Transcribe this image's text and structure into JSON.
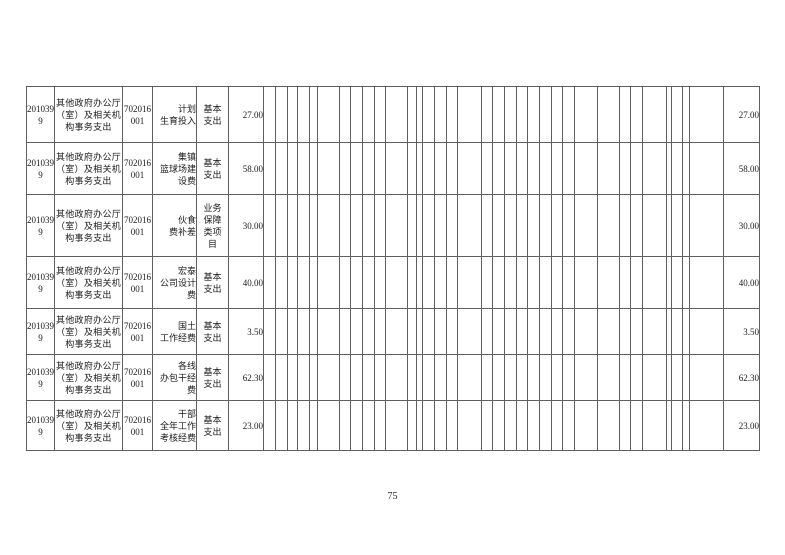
{
  "page": {
    "number": "75"
  },
  "colors": {
    "border": "#5f5f5f",
    "text": "#1b1b1b",
    "background": "#ffffff"
  },
  "table": {
    "rows": [
      {
        "func_code": "201039\n9",
        "func_name": "其他政府办公厅\n（室）及相关机\n构事务支出",
        "econ_code": "702016\n001",
        "project": "计划\n生育投入",
        "expense_type": "基本\n支出",
        "amount": "27.00",
        "amount_total": "27.00"
      },
      {
        "func_code": "201039\n9",
        "func_name": "其他政府办公厅\n（室）及相关机\n构事务支出",
        "econ_code": "702016\n001",
        "project": "集镇\n篮球场建\n设费",
        "expense_type": "基本\n支出",
        "amount": "58.00",
        "amount_total": "58.00"
      },
      {
        "func_code": "201039\n9",
        "func_name": "其他政府办公厅\n（室）及相关机\n构事务支出",
        "econ_code": "702016\n001",
        "project": "伙食\n费补差",
        "expense_type": "业务\n保障\n类项\n目",
        "amount": "30.00",
        "amount_total": "30.00"
      },
      {
        "func_code": "201039\n9",
        "func_name": "其他政府办公厅\n（室）及相关机\n构事务支出",
        "econ_code": "702016\n001",
        "project": "宏泰\n公司设计\n费",
        "expense_type": "基本\n支出",
        "amount": "40.00",
        "amount_total": "40.00"
      },
      {
        "func_code": "201039\n9",
        "func_name": "其他政府办公厅\n（室）及相关机\n构事务支出",
        "econ_code": "702016\n001",
        "project": "国土\n工作经费",
        "expense_type": "基本\n支出",
        "amount": "3.50",
        "amount_total": "3.50"
      },
      {
        "func_code": "201039\n9",
        "func_name": "其他政府办公厅\n（室）及相关机\n构事务支出",
        "econ_code": "702016\n001",
        "project": "各线\n办包干经\n费",
        "expense_type": "基本\n支出",
        "amount": "62.30",
        "amount_total": "62.30"
      },
      {
        "func_code": "201039\n9",
        "func_name": "其他政府办公厅\n（室）及相关机\n构事务支出",
        "econ_code": "702016\n001",
        "project": "干部\n全年工作\n考核经费",
        "expense_type": "基本\n支出",
        "amount": "23.00",
        "amount_total": "23.00"
      }
    ]
  }
}
